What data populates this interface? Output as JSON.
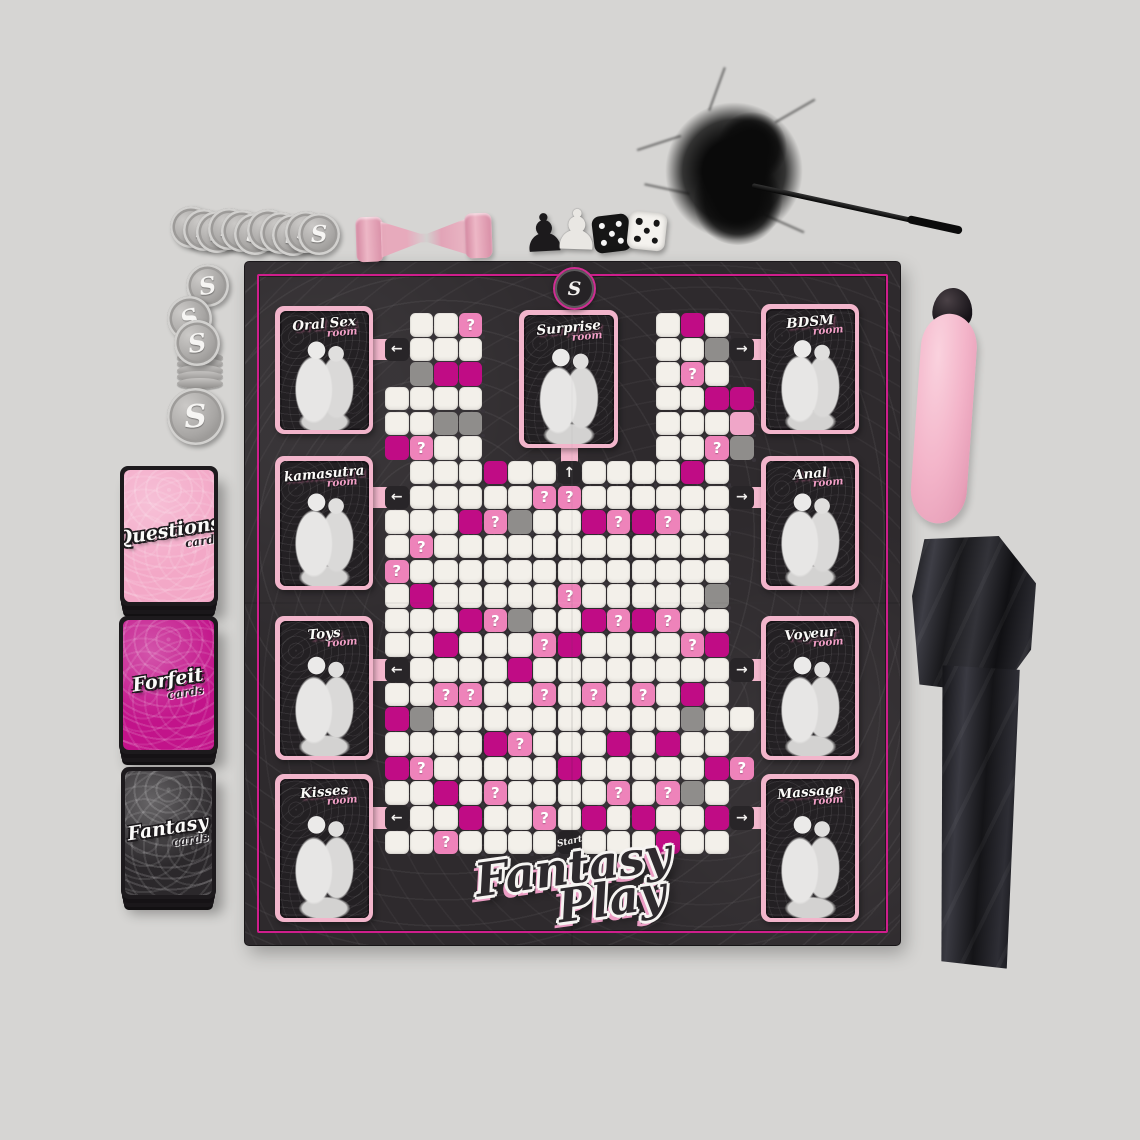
{
  "scene": {
    "background_color": "#d6d5d3"
  },
  "board": {
    "bg_color": "#2e2a2d",
    "frame_color": "#cf1e8c",
    "tab_color": "#f3b7cd",
    "logo_letter": "S",
    "title": {
      "line1": "Fantasy",
      "line2": "Play"
    },
    "start_label": "Start",
    "question_glyph": "?",
    "arrows": {
      "left": "←",
      "right": "→",
      "up": "↑"
    },
    "rooms": [
      {
        "id": "oral-sex",
        "name": "Oral Sex",
        "suffix": "room",
        "side": "left"
      },
      {
        "id": "kamasutra",
        "name": "kamasutra",
        "suffix": "room",
        "side": "left"
      },
      {
        "id": "toys",
        "name": "Toys",
        "suffix": "room",
        "side": "left"
      },
      {
        "id": "kisses",
        "name": "Kisses",
        "suffix": "room",
        "side": "left"
      },
      {
        "id": "surprise",
        "name": "Surprise",
        "suffix": "room",
        "side": "top"
      },
      {
        "id": "bdsm",
        "name": "BDSM",
        "suffix": "room",
        "side": "right"
      },
      {
        "id": "anal",
        "name": "Anal",
        "suffix": "room",
        "side": "right"
      },
      {
        "id": "voyeur",
        "name": "Voyeur",
        "suffix": "room",
        "side": "right"
      },
      {
        "id": "massage",
        "name": "Massage",
        "suffix": "room",
        "side": "right"
      }
    ],
    "grid": {
      "cols": 15,
      "rows": 22,
      "legend": "w=white p=pink P=pink with ? m=magenta g=gray <,>,A=arrow tiles S=start .=empty",
      "cell_colors": {
        "w": "#f3f0ea",
        "p": "#f0a6c8",
        "P": "#ee83ba",
        "m": "#c00c85",
        "g": "#8f8d8b",
        "tile": "#282528"
      },
      "layout": [
        ".wwP.......wmw.",
        "<www.......wwg>",
        ".gmm.......wPw.",
        "wwww.......wwmm",
        "wwgg.......wwwp",
        "mPww.......wwPg",
        ".wwwmwwAwwwwmw.",
        "<wwwwwPPwwwwww>",
        "wwwmPgwwmPmPww.",
        "wPwwwwwwwwwwww.",
        "Pwwwwwwwwwwwww.",
        "wmwwwwwPwwwwwg.",
        "wwwmPgwwmPmPww.",
        "wwmwwwPmwwwwPm.",
        "<wwwwmwwwwwwww>",
        "wwPPwwPwPwPwmw.",
        "mgwwwwwwwwwwgww",
        "wwwwmPwwwmwmww.",
        "mPwwwwwmwwwwwmP",
        "wwmwPwwwwPwPgw.",
        "<wwmwwPwmwmwwm>",
        "wwPwwwwSwwwmww."
      ]
    }
  },
  "decks": [
    {
      "id": "questions",
      "line1": "Questions",
      "line2": "cards",
      "back_color": "#f3a8c7"
    },
    {
      "id": "forfeit",
      "line1": "Forfeit",
      "line2": "cards",
      "back_color": "#c2138a"
    },
    {
      "id": "fantasy",
      "line1": "Fantasy",
      "line2": "cards",
      "back_color": "#2b282b"
    }
  ],
  "components": {
    "tokens": {
      "letter": "S",
      "color": "#a6a4a2",
      "fan_count": 11,
      "loose_count": 4,
      "stack_side_coins": 5
    },
    "hourglass": {
      "frame_color": "#e294ab",
      "sand_color": "#eab6c4"
    },
    "pawns": [
      {
        "id": "black-pawn",
        "glyph": "♟",
        "color": "#1c1a1c"
      },
      {
        "id": "white-pawn",
        "glyph": "♟",
        "color": "#e9e7e3"
      }
    ],
    "dice": [
      {
        "id": "black-die",
        "face_value": 5,
        "body_color": "#161616",
        "pip_color": "#f5f5f5"
      },
      {
        "id": "white-die",
        "face_value": 5,
        "body_color": "#f4f2ee",
        "pip_color": "#161616"
      }
    ],
    "feather_tickler": {
      "color": "#0c0c0c"
    },
    "vibrator": {
      "body_color": "#f3b6cb",
      "cap_color": "#19161a"
    },
    "blindfold": {
      "color": "#1a191d"
    }
  }
}
